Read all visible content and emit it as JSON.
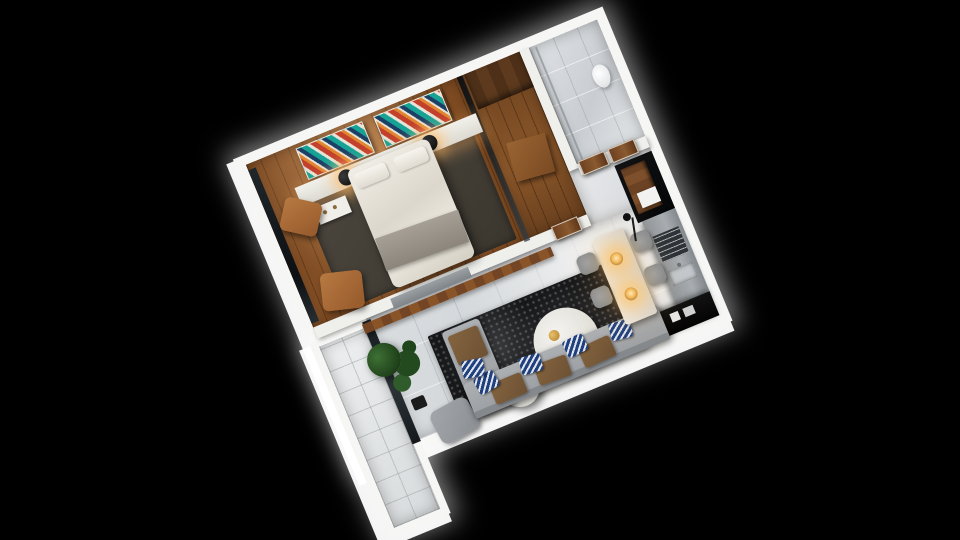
{
  "scene": {
    "type": "3d_apartment_floor_plan_render",
    "background_color": "#000000",
    "view": {
      "projection": "top-down cutaway render",
      "plan_rotation_deg": -22.5
    },
    "palette": {
      "walls": "#f6f6f4",
      "bedroom_wood_floor": "#8a5326",
      "living_marble_floor": "#d7dadd",
      "balcony_tile": "#e3e5e6",
      "bedroom_rug": "#44403a",
      "living_rug": "#17181a",
      "sofa_gray": "#a7abae",
      "cushion_brown": "#7b5c41",
      "pillow_navy": "#20407e",
      "art_teal": "#17a296",
      "art_red": "#c2402c",
      "art_orange": "#e0862f",
      "door_walnut": "#6e4120",
      "kitchen_black": "#0b0d0e",
      "cabinet_gray": "#9ba0a4",
      "warm_lamp_glow": "#ffc46e",
      "plant_green": "#2c5526",
      "gold_accent": "#c89a3c"
    },
    "rooms": [
      {
        "name": "bedroom",
        "floor": "walnut plank wood",
        "contents": [
          "double bed with white duvet and gray throw",
          "two headboard pillows",
          "white headboard ledge",
          "two lit black sphere table lamps",
          "two multicolor diagonal-striped artworks",
          "dark area rug",
          "two tan leather lounge chairs",
          "white vanity tray",
          "full-height window wall"
        ]
      },
      {
        "name": "wardrobe",
        "floor": "walnut plank wood",
        "contents": [
          "smoked glass partition",
          "dark walnut wardrobe unit",
          "wood bench"
        ]
      },
      {
        "name": "bathroom",
        "floor": "white marble tile",
        "contents": [
          "toilet",
          "glass shower screen"
        ]
      },
      {
        "name": "hallway",
        "floor": "light marble",
        "contents": [
          "three walnut interior doors"
        ]
      },
      {
        "name": "kitchen",
        "floor": "light marble",
        "contents": [
          "black feature wall",
          "tall walnut cabinet",
          "gray counter run",
          "stainless cooktop",
          "stainless sink",
          "black island counter with white dishes"
        ]
      },
      {
        "name": "living_dining",
        "floor": "light marble tile",
        "contents": [
          "gray corner sofa",
          "three brown seat cushions",
          "five navy chevron throw pillows",
          "charcoal mottled rug",
          "large round white coffee table",
          "small round white coffee table",
          "gold decor pieces",
          "white tray card",
          "wall-mounted gray TV panel",
          "long walnut media shelf",
          "potted tree",
          "gray armchair",
          "dining table",
          "four gray dining chairs",
          "two lit brass pendant lights",
          "black arc floor lamp"
        ]
      },
      {
        "name": "balcony",
        "floor": "pale ceramic tile",
        "contents": [
          "dark sliding glass door"
        ]
      }
    ]
  }
}
